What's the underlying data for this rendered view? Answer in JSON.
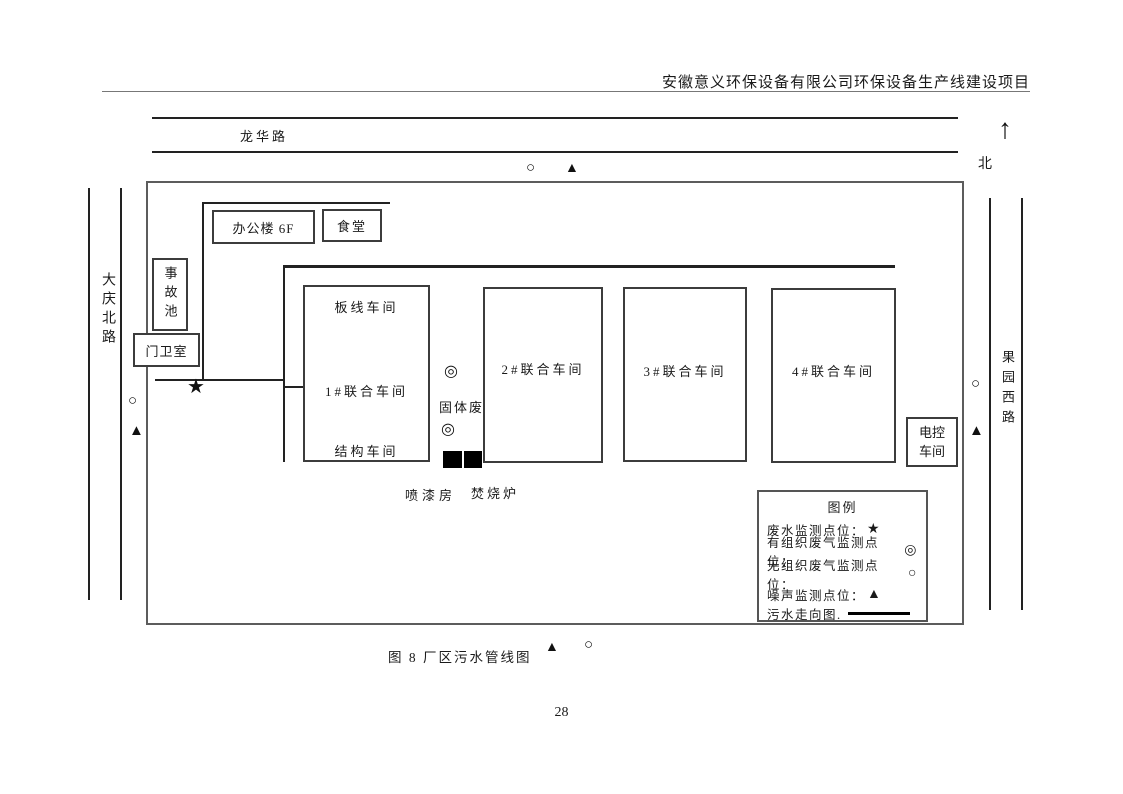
{
  "header": {
    "title": "安徽意义环保设备有限公司环保设备生产线建设项目"
  },
  "compass": {
    "arrow": "↑",
    "north_label": "北"
  },
  "roads": {
    "top": "龙华路",
    "left": "大庆北路",
    "right": "果园西路"
  },
  "symbols": {
    "star": "★",
    "double_circle": "◎",
    "circle": "○",
    "triangle": "▲"
  },
  "buildings": {
    "office": "办公楼 6F",
    "canteen": "食堂",
    "accident_pool": "事故池",
    "guard_room": "门卫室",
    "board_line_workshop": "板线车间",
    "workshop1": "1#联合车间",
    "structure_workshop": "结构车间",
    "workshop2": "2#联合车间",
    "workshop3": "3#联合车间",
    "workshop4": "4#联合车间",
    "electric_control_line1": "电控",
    "electric_control_line2": "车间",
    "solid_waste": "固体废",
    "paint_room": "喷漆房",
    "incinerator": "焚烧炉"
  },
  "legend": {
    "title": "图例",
    "items": [
      {
        "label": "废水监测点位：",
        "symbol": "★"
      },
      {
        "label": "有组织废气监测点位：",
        "symbol": "◎"
      },
      {
        "label": "无组织废气监测点位：",
        "symbol": "○"
      },
      {
        "label": "噪声监测点位：",
        "symbol": "▲"
      },
      {
        "label": "污水走向图.",
        "symbol": ""
      }
    ]
  },
  "caption": {
    "text": "图 8  厂区污水管线图"
  },
  "page_number": "28"
}
